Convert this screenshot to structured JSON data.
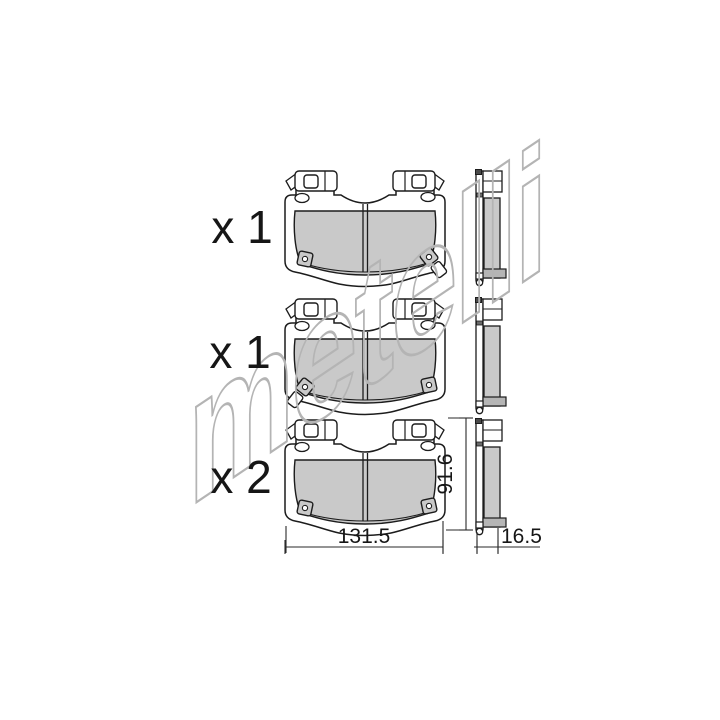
{
  "drawing": {
    "type": "brake-pad-set-technical-drawing",
    "watermark": {
      "text": "metelli"
    },
    "items": [
      {
        "id": "pad-front-sensor-right",
        "quantity_label": "x 1"
      },
      {
        "id": "pad-front-sensor-left",
        "quantity_label": "x 1"
      },
      {
        "id": "pad-front-no-sensor",
        "quantity_label": "x 2"
      }
    ],
    "dimensions": {
      "width_mm": "131.5",
      "height_mm": "91.6",
      "thickness_mm": "16.5"
    },
    "colors": {
      "background": "#ffffff",
      "line": "#1c1c1c",
      "friction_material": "#c9c9c9",
      "foot_shim": "#b5b5b5",
      "watermark": "#b4b4b4"
    }
  }
}
